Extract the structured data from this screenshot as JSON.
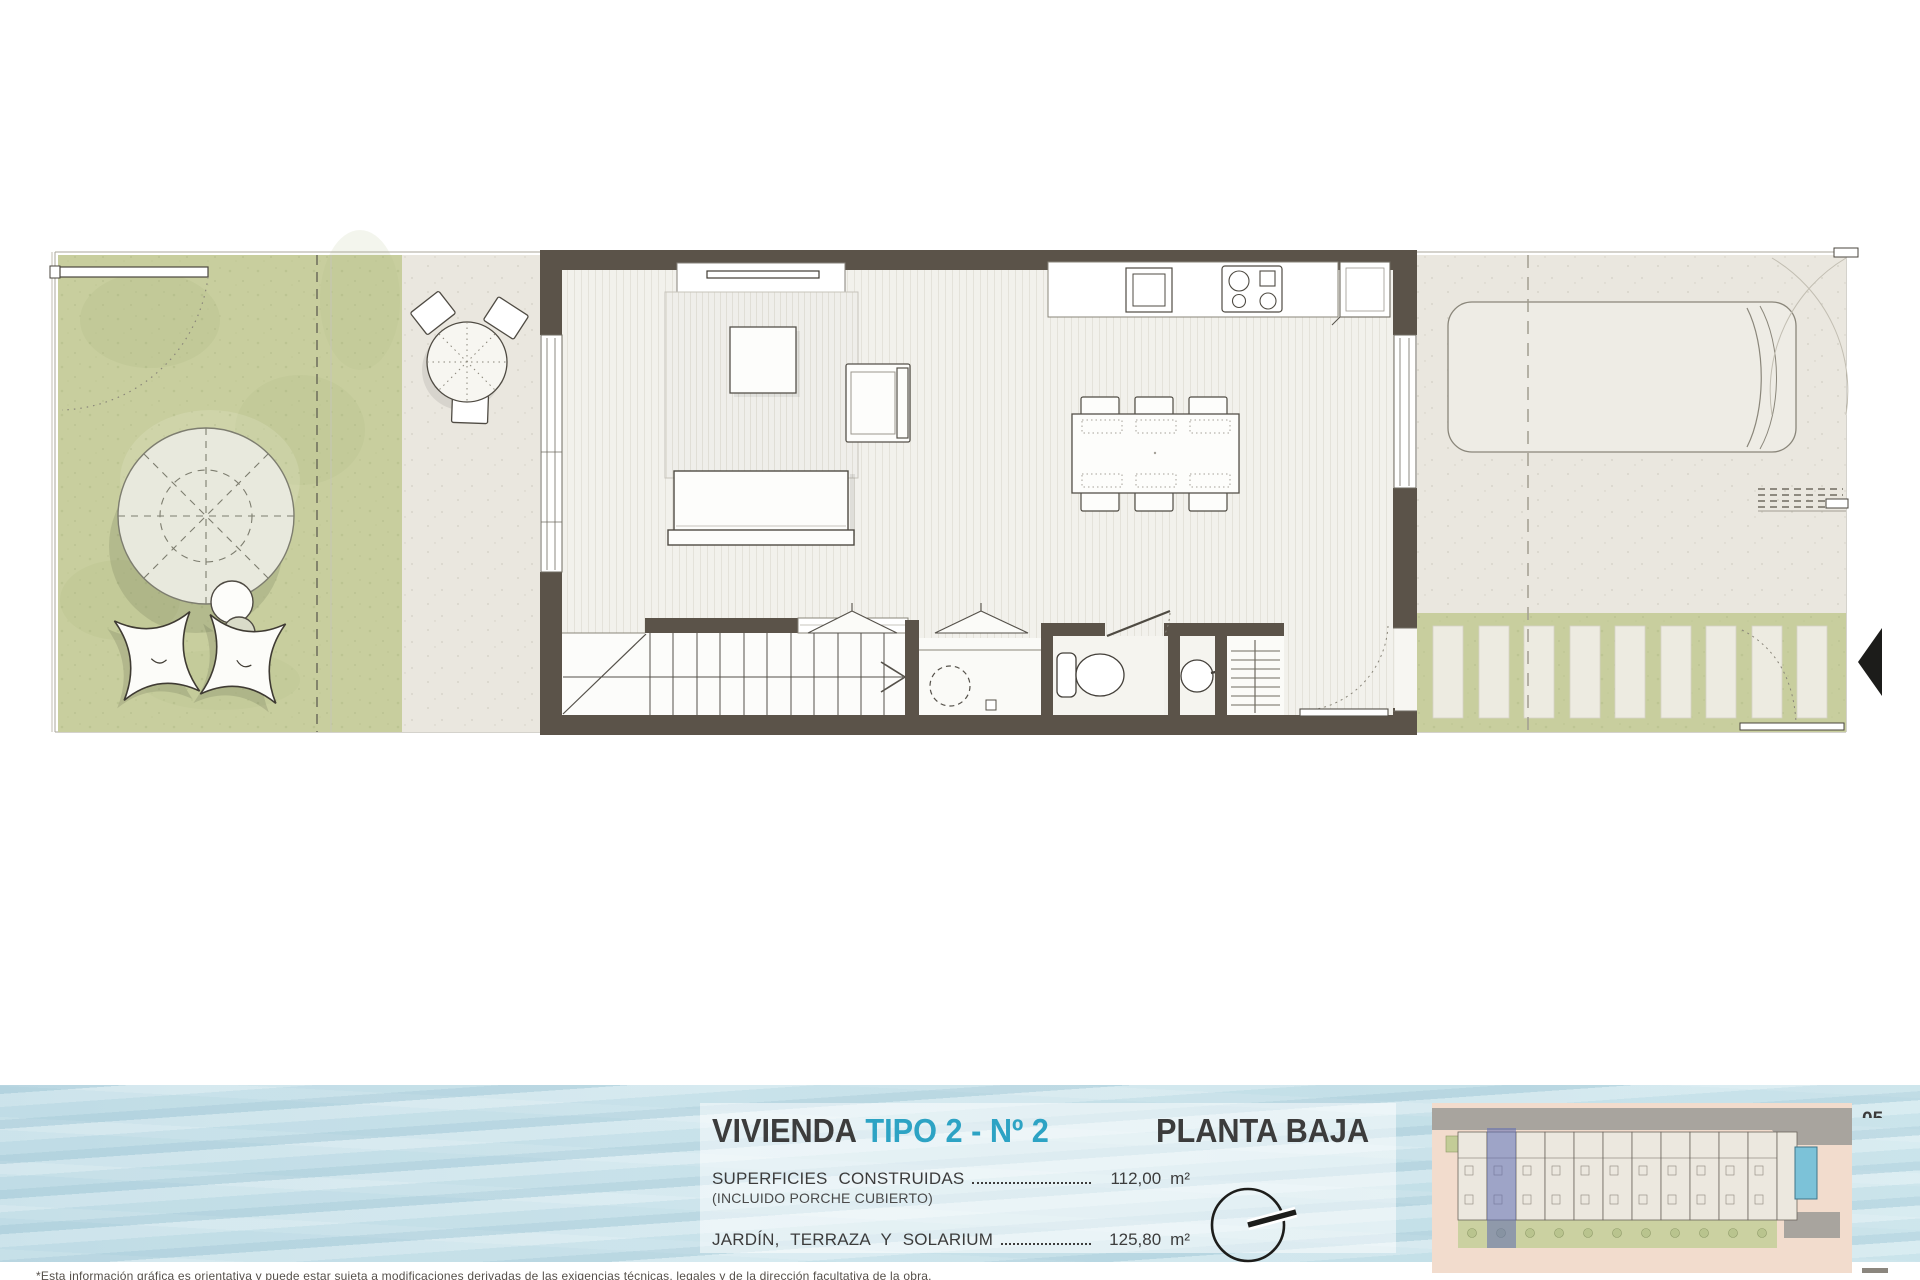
{
  "title_block": {
    "project_label": "VIVIENDA",
    "type_label": "TIPO 2 - Nº 2",
    "plan_label": "PLANTA BAJA",
    "surfaces": [
      {
        "label": "SUPERFICIES CONSTRUIDAS",
        "note": "(INCLUIDO PORCHE CUBIERTO)",
        "value": "112,00",
        "unit": "m²"
      },
      {
        "label": "JARDÍN, TERRAZA Y SOLARIUM",
        "note": "",
        "value": "125,80",
        "unit": "m²"
      }
    ]
  },
  "site_map": {
    "unit_count": 11,
    "highlighted_unit_index": 1
  },
  "page_number": "05",
  "disclaimer": "*Esta información gráfica es orientativa y puede estar sujeta a modificaciones derivadas de las exigencias técnicas, legales y de la dirección facultativa de la obra.",
  "colors": {
    "accent": "#2da3c4",
    "wall": "#5b5349",
    "garden_green": "#c8ce9e",
    "terrace_beige": "#eae7df",
    "water_blue": "#cde3e9",
    "highlight_unit": "#5e6cb2",
    "pool_blue": "#7cc2d8"
  }
}
